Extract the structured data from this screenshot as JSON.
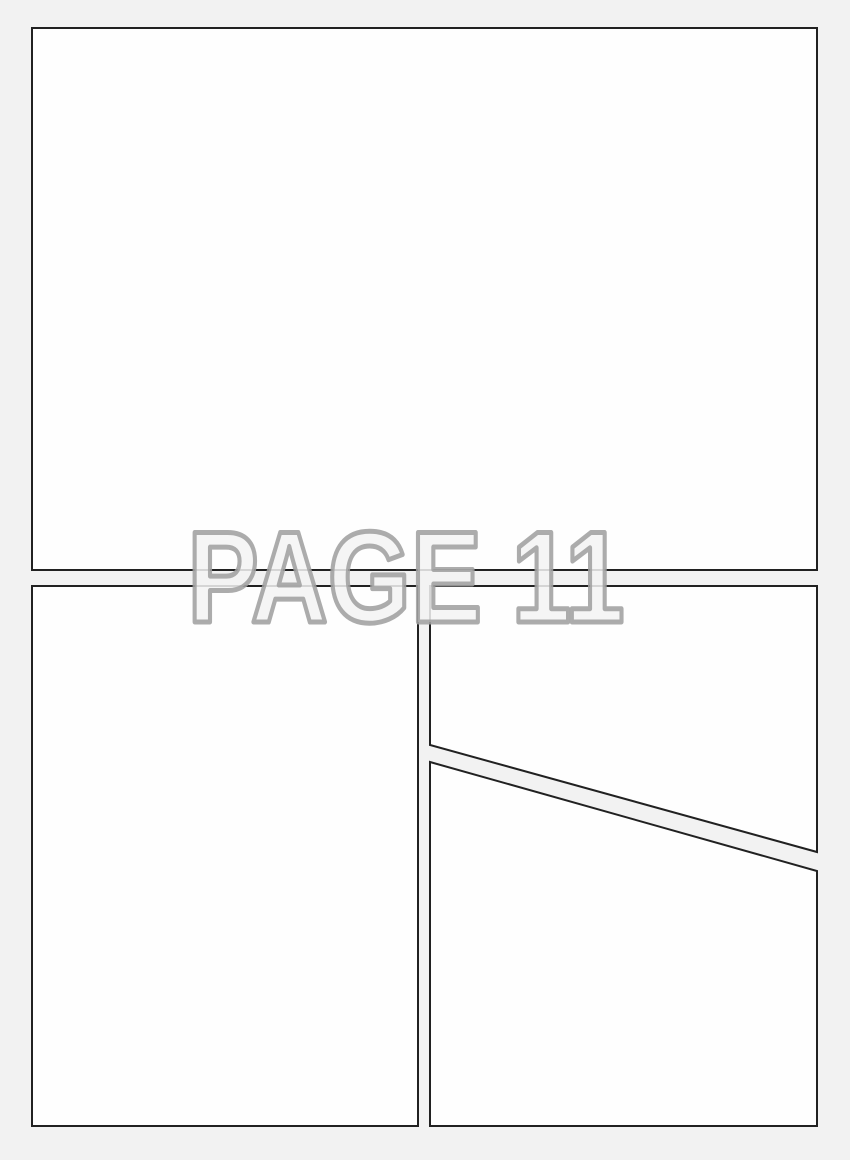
{
  "watermark": {
    "text": "PAGE 11"
  },
  "theme": {
    "background": "#f2f2f2",
    "panel_fill": "#fefefe",
    "panel_border": "#212121",
    "watermark_fill": "#f3f3f3",
    "watermark_stroke": "#a0a0a0"
  },
  "panels": [
    {
      "id": "top",
      "shape": "rectangle"
    },
    {
      "id": "bottom-left",
      "shape": "rectangle"
    },
    {
      "id": "top-right",
      "shape": "diagonal-bottom"
    },
    {
      "id": "bottom-right",
      "shape": "diagonal-top"
    }
  ]
}
